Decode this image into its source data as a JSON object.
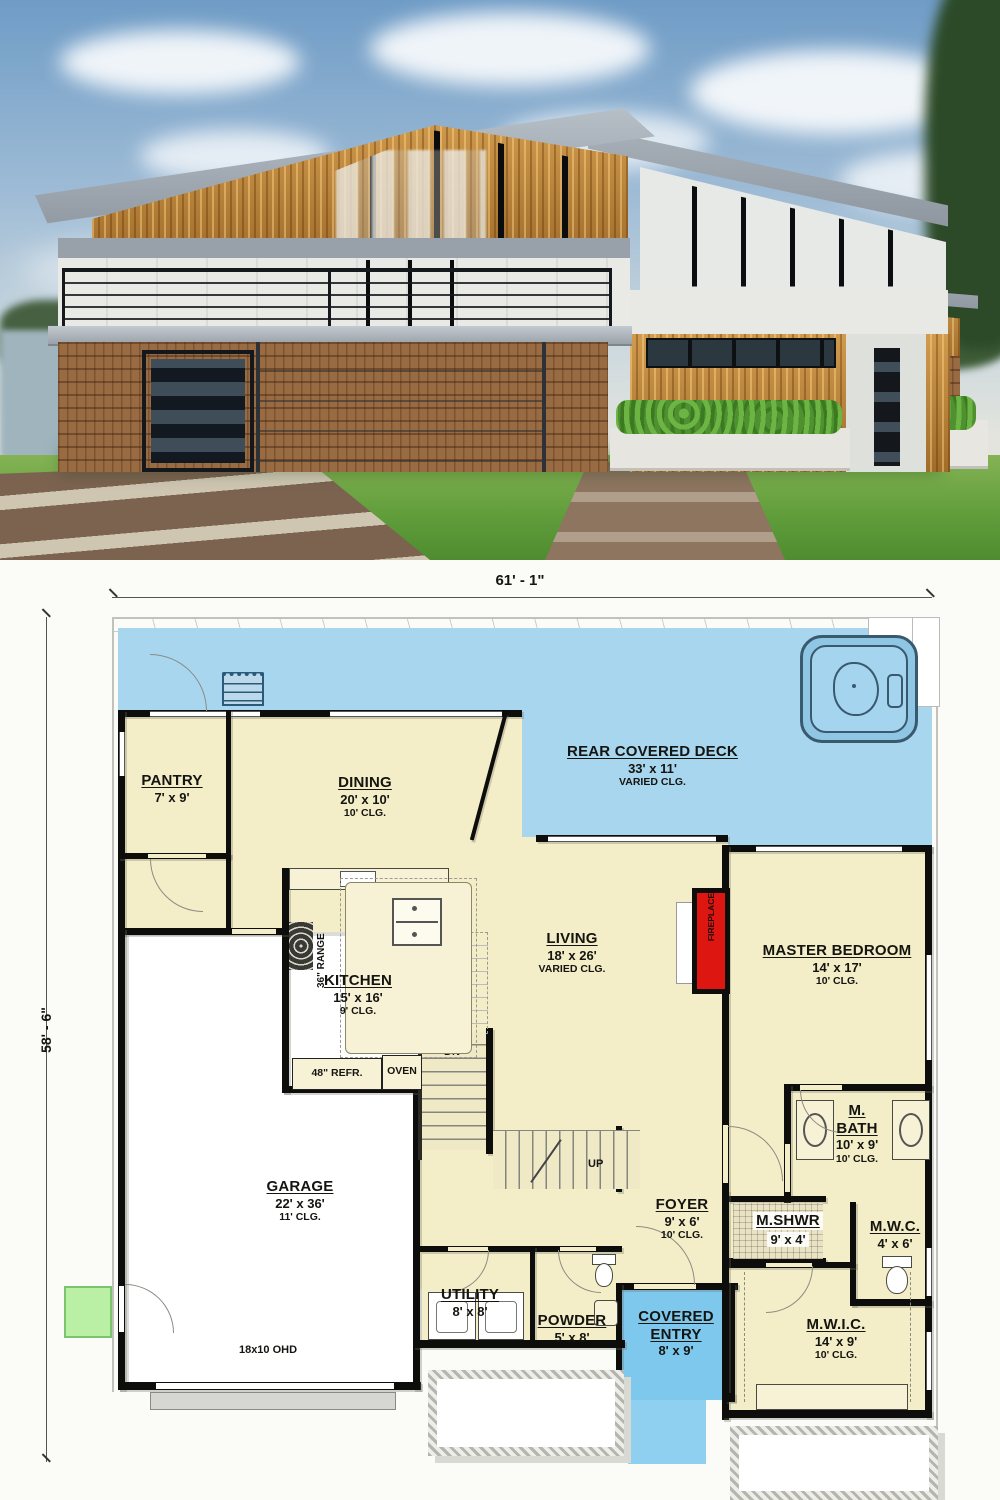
{
  "plan": {
    "dimensions": {
      "width": "61' - 1\"",
      "height": "58' - 6\""
    },
    "rooms": {
      "deck": {
        "name": "REAR COVERED DECK",
        "dims": "33' x 11'",
        "clg": "VARIED CLG."
      },
      "pantry": {
        "name": "PANTRY",
        "dims": "7' x 9'",
        "clg": ""
      },
      "dining": {
        "name": "DINING",
        "dims": "20' x 10'",
        "clg": "10' CLG."
      },
      "kitchen": {
        "name": "KITCHEN",
        "dims": "15' x 16'",
        "clg": "9' CLG."
      },
      "living": {
        "name": "LIVING",
        "dims": "18' x 26'",
        "clg": "VARIED CLG."
      },
      "master": {
        "name": "MASTER BEDROOM",
        "dims": "14' x 17'",
        "clg": "10' CLG."
      },
      "garage": {
        "name": "GARAGE",
        "dims": "22' x 36'",
        "clg": "11' CLG."
      },
      "mbath": {
        "name": "M. BATH",
        "dims": "10' x 9'",
        "clg": "10' CLG."
      },
      "mshwr": {
        "name": "M.SHWR",
        "dims": "9' x 4'",
        "clg": ""
      },
      "mwc": {
        "name": "M.W.C.",
        "dims": "4' x 6'",
        "clg": ""
      },
      "foyer": {
        "name": "FOYER",
        "dims": "9' x 6'",
        "clg": "10' CLG."
      },
      "utility": {
        "name": "UTILITY",
        "dims": "8' x 8'",
        "clg": ""
      },
      "powder": {
        "name": "POWDER",
        "dims": "5' x 8'",
        "clg": ""
      },
      "entry": {
        "name": "COVERED ENTRY",
        "dims": "8' x 9'",
        "clg": ""
      },
      "mwic": {
        "name": "M.W.I.C.",
        "dims": "14' x 9'",
        "clg": "10' CLG."
      }
    },
    "annotations": {
      "dn": "DN",
      "up": "UP",
      "range": "36\" RANGE",
      "refr": "48\" REFR.",
      "oven": "OVEN",
      "fireplace": "FIREPLACE",
      "ohd": "18x10 OHD"
    },
    "colors": {
      "deck_blue": "#a9d6ef",
      "entry_blue": "#7ec8ee",
      "room_cream": "#f4eec8",
      "fireplace_red": "#dd1612",
      "pad_green": "#b9f0a6",
      "wall_black": "#0d0d0b"
    }
  }
}
